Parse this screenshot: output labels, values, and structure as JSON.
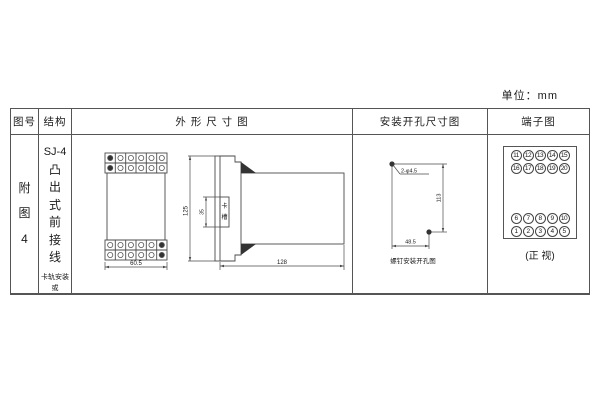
{
  "unit_label": "单位：mm",
  "table": {
    "headers": {
      "fig_no": "图号",
      "structure": "结构",
      "outline": "外 形 尺 寸 图",
      "mounting": "安装开孔尺寸图",
      "terminal": "端子图"
    },
    "fig_no_text": "附图4",
    "structure": {
      "model": "SJ-4",
      "type_vertical": "凸出式前接线",
      "mounting_note": "卡轨安装\n或\n螺钉安装"
    }
  },
  "outline_view": {
    "front": {
      "width_dim": "60.5"
    },
    "side": {
      "height_dim": "125",
      "slot_dim": "35",
      "slot_label_chars": [
        "卡",
        "槽"
      ],
      "depth_dim": "128"
    }
  },
  "mounting_view": {
    "hole_label": "2-φ4.5",
    "height_dim": "113",
    "width_dim": "48.5",
    "caption": "螺钉安装开孔图"
  },
  "terminal_diagram": {
    "rows": [
      [
        11,
        12,
        13,
        14,
        15
      ],
      [
        16,
        17,
        18,
        19,
        20
      ],
      [
        6,
        7,
        8,
        9,
        10
      ],
      [
        1,
        2,
        3,
        4,
        5
      ]
    ],
    "caption": "(正 视)"
  },
  "colors": {
    "line": "#4a4a4a",
    "text": "#1a1a1a",
    "background": "#ffffff"
  }
}
